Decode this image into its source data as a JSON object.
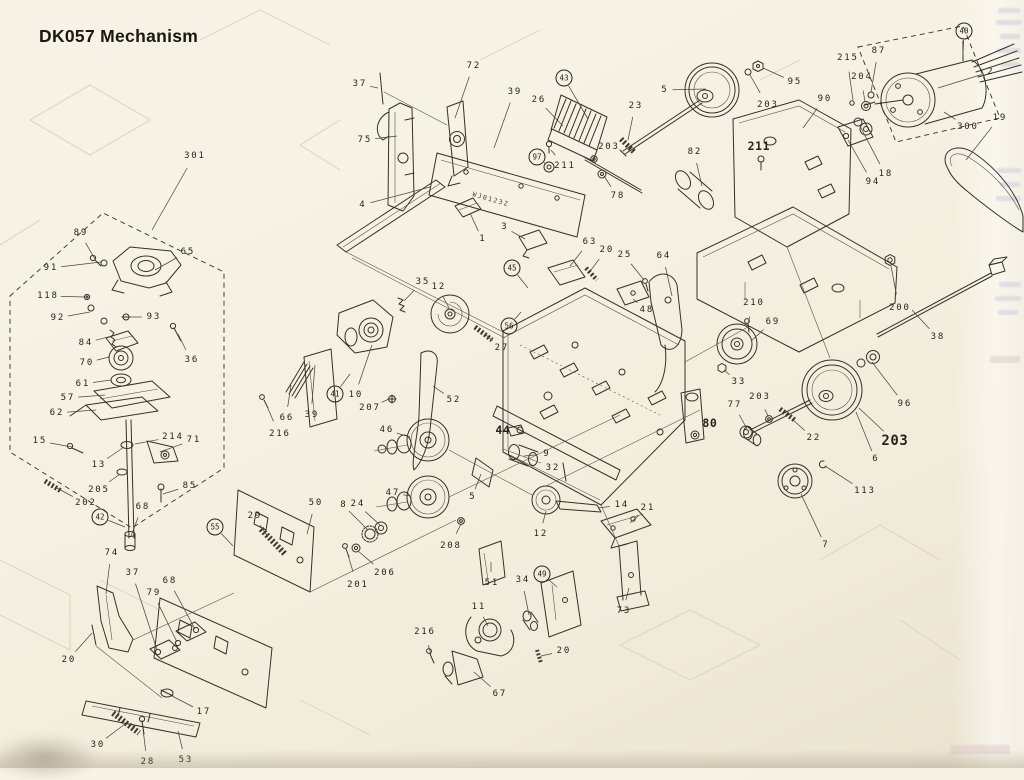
{
  "page": {
    "title": "DK057 Mechanism",
    "background": "#f5f0e2",
    "ink": "#2f2d28",
    "leader_color": "#4b4841"
  },
  "diagram": {
    "board_text": "WJ0123Z",
    "labels": [
      {
        "t": "301",
        "x": 194,
        "y": 156,
        "tx": 152,
        "ty": 230
      },
      {
        "t": "89",
        "x": 80,
        "y": 233,
        "tx": 96,
        "ty": 261
      },
      {
        "t": "65",
        "x": 187,
        "y": 252,
        "tx": 155,
        "ty": 270
      },
      {
        "t": "91",
        "x": 50,
        "y": 268,
        "tx": 101,
        "ty": 262
      },
      {
        "t": "118",
        "x": 47,
        "y": 296,
        "tx": 85,
        "ty": 297
      },
      {
        "t": "92",
        "x": 57,
        "y": 318,
        "tx": 90,
        "ty": 312
      },
      {
        "t": "93",
        "x": 153,
        "y": 317,
        "tx": 129,
        "ty": 317
      },
      {
        "t": "84",
        "x": 85,
        "y": 343,
        "tx": 112,
        "ty": 336
      },
      {
        "t": "36",
        "x": 191,
        "y": 360,
        "tx": 178,
        "ty": 334
      },
      {
        "t": "70",
        "x": 86,
        "y": 363,
        "tx": 109,
        "ty": 357
      },
      {
        "t": "61",
        "x": 82,
        "y": 384,
        "tx": 111,
        "ty": 380
      },
      {
        "t": "57",
        "x": 67,
        "y": 398,
        "tx": 105,
        "ty": 395
      },
      {
        "t": "62",
        "x": 56,
        "y": 413,
        "tx": 96,
        "ty": 410
      },
      {
        "t": "15",
        "x": 39,
        "y": 441,
        "tx": 72,
        "ty": 447
      },
      {
        "t": "214",
        "x": 172,
        "y": 437,
        "tx": 135,
        "ty": 444
      },
      {
        "t": "71",
        "x": 193,
        "y": 440,
        "tx": 160,
        "ty": 452
      },
      {
        "t": "13",
        "x": 98,
        "y": 465,
        "tx": 124,
        "ty": 447
      },
      {
        "t": "205",
        "x": 98,
        "y": 490,
        "tx": 120,
        "ty": 474
      },
      {
        "t": "85",
        "x": 189,
        "y": 486,
        "tx": 163,
        "ty": 494
      },
      {
        "t": "202",
        "x": 85,
        "y": 503,
        "tx": 55,
        "ty": 487
      },
      {
        "t": "42",
        "x": 100,
        "y": 517,
        "tx": 125,
        "ty": 527,
        "s": "circle"
      },
      {
        "t": "68",
        "x": 142,
        "y": 507,
        "tx": 131,
        "ty": 536
      },
      {
        "t": "74",
        "x": 111,
        "y": 553,
        "tx": 106,
        "ty": 594
      },
      {
        "t": "37",
        "x": 132,
        "y": 573,
        "tx": 157,
        "ty": 650
      },
      {
        "t": "79",
        "x": 153,
        "y": 593,
        "tx": 177,
        "ty": 642
      },
      {
        "t": "68",
        "x": 169,
        "y": 581,
        "tx": 195,
        "ty": 629
      },
      {
        "t": "20",
        "x": 68,
        "y": 660,
        "tx": 92,
        "ty": 633
      },
      {
        "t": "17",
        "x": 203,
        "y": 712,
        "tx": 172,
        "ty": 696
      },
      {
        "t": "30",
        "x": 97,
        "y": 745,
        "tx": 125,
        "ty": 724
      },
      {
        "t": "28",
        "x": 147,
        "y": 762,
        "tx": 143,
        "ty": 729
      },
      {
        "t": "53",
        "x": 185,
        "y": 760,
        "tx": 178,
        "ty": 731
      },
      {
        "t": "37",
        "x": 359,
        "y": 84,
        "tx": 378,
        "ty": 88
      },
      {
        "t": "72",
        "x": 473,
        "y": 66,
        "tx": 455,
        "ty": 118
      },
      {
        "t": "75",
        "x": 364,
        "y": 140,
        "tx": 397,
        "ty": 136
      },
      {
        "t": "4",
        "x": 362,
        "y": 205,
        "tx": 430,
        "ty": 187
      },
      {
        "t": "39",
        "x": 514,
        "y": 92,
        "tx": 494,
        "ty": 148
      },
      {
        "t": "26",
        "x": 538,
        "y": 100,
        "tx": 563,
        "ty": 126
      },
      {
        "t": "43",
        "x": 564,
        "y": 78,
        "tx": 588,
        "ty": 119,
        "s": "circle"
      },
      {
        "t": "97",
        "x": 537,
        "y": 157,
        "tx": 546,
        "ty": 164,
        "s": "circle"
      },
      {
        "t": "211",
        "x": 564,
        "y": 166,
        "tx": 551,
        "ty": 150
      },
      {
        "t": "203",
        "x": 608,
        "y": 147,
        "tx": 596,
        "ty": 157
      },
      {
        "t": "78",
        "x": 617,
        "y": 196,
        "tx": 604,
        "ty": 176
      },
      {
        "t": "1",
        "x": 482,
        "y": 239,
        "tx": 470,
        "ty": 213
      },
      {
        "t": "3",
        "x": 504,
        "y": 227,
        "tx": 525,
        "ty": 239
      },
      {
        "t": "63",
        "x": 589,
        "y": 242,
        "tx": 570,
        "ty": 266
      },
      {
        "t": "23",
        "x": 635,
        "y": 106,
        "tx": 628,
        "ty": 140
      },
      {
        "t": "5",
        "x": 664,
        "y": 90,
        "tx": 706,
        "ty": 89
      },
      {
        "t": "95",
        "x": 794,
        "y": 82,
        "tx": 763,
        "ty": 68
      },
      {
        "t": "203",
        "x": 767,
        "y": 105,
        "tx": 750,
        "ty": 75
      },
      {
        "t": "90",
        "x": 824,
        "y": 99,
        "tx": 803,
        "ty": 128
      },
      {
        "t": "82",
        "x": 694,
        "y": 152,
        "tx": 702,
        "ty": 186
      },
      {
        "t": "211",
        "x": 758,
        "y": 146,
        "tx": 761,
        "ty": 160,
        "s": "bold"
      },
      {
        "t": "215",
        "x": 847,
        "y": 58,
        "tx": 853,
        "ty": 100
      },
      {
        "t": "87",
        "x": 878,
        "y": 51,
        "tx": 871,
        "ty": 92
      },
      {
        "t": "204",
        "x": 861,
        "y": 77,
        "tx": 865,
        "ty": 102
      },
      {
        "t": "40",
        "x": 964,
        "y": 31,
        "tx": 963,
        "ty": 55,
        "s": "circle"
      },
      {
        "t": "2",
        "x": 990,
        "y": 72,
        "tx": 938,
        "ty": 88
      },
      {
        "t": "300",
        "x": 967,
        "y": 127,
        "tx": 944,
        "ty": 112
      },
      {
        "t": "19",
        "x": 999,
        "y": 118,
        "tx": 966,
        "ty": 160
      },
      {
        "t": "94",
        "x": 872,
        "y": 182,
        "tx": 848,
        "ty": 140
      },
      {
        "t": "18",
        "x": 885,
        "y": 174,
        "tx": 860,
        "ty": 126
      },
      {
        "t": "20",
        "x": 606,
        "y": 250,
        "tx": 591,
        "ty": 270
      },
      {
        "t": "25",
        "x": 624,
        "y": 255,
        "tx": 644,
        "ty": 280
      },
      {
        "t": "64",
        "x": 663,
        "y": 256,
        "tx": 672,
        "ty": 296
      },
      {
        "t": "48",
        "x": 646,
        "y": 310,
        "tx": 633,
        "ty": 299
      },
      {
        "t": "45",
        "x": 512,
        "y": 268,
        "tx": 528,
        "ty": 288,
        "s": "circle"
      },
      {
        "t": "56",
        "x": 509,
        "y": 326,
        "tx": 521,
        "ty": 312,
        "s": "circle"
      },
      {
        "t": "27",
        "x": 501,
        "y": 348,
        "tx": 486,
        "ty": 335
      },
      {
        "t": "210",
        "x": 753,
        "y": 303,
        "tx": 748,
        "ty": 324
      },
      {
        "t": "69",
        "x": 772,
        "y": 322,
        "tx": 751,
        "ty": 341
      },
      {
        "t": "200",
        "x": 899,
        "y": 308,
        "tx": 891,
        "ty": 266
      },
      {
        "t": "38",
        "x": 937,
        "y": 337,
        "tx": 912,
        "ty": 310
      },
      {
        "t": "33",
        "x": 738,
        "y": 382,
        "tx": 724,
        "ty": 370
      },
      {
        "t": "203",
        "x": 759,
        "y": 397,
        "tx": 768,
        "ty": 416
      },
      {
        "t": "77",
        "x": 734,
        "y": 405,
        "tx": 747,
        "ty": 429
      },
      {
        "t": "22",
        "x": 813,
        "y": 438,
        "tx": 792,
        "ty": 419
      },
      {
        "t": "96",
        "x": 904,
        "y": 404,
        "tx": 872,
        "ty": 362
      },
      {
        "t": "203",
        "x": 894,
        "y": 441,
        "tx": 859,
        "ty": 408,
        "s": "big"
      },
      {
        "t": "6",
        "x": 875,
        "y": 459,
        "tx": 856,
        "ty": 412
      },
      {
        "t": "113",
        "x": 864,
        "y": 491,
        "tx": 825,
        "ty": 466
      },
      {
        "t": "7",
        "x": 825,
        "y": 545,
        "tx": 801,
        "ty": 494
      },
      {
        "t": "80",
        "x": 709,
        "y": 423,
        "tx": 698,
        "ty": 419,
        "s": "bold"
      },
      {
        "t": "35",
        "x": 422,
        "y": 282,
        "tx": 404,
        "ty": 301
      },
      {
        "t": "12",
        "x": 438,
        "y": 287,
        "tx": 449,
        "ty": 308
      },
      {
        "t": "41",
        "x": 335,
        "y": 394,
        "tx": 350,
        "ty": 374,
        "s": "circle"
      },
      {
        "t": "10",
        "x": 355,
        "y": 395,
        "tx": 372,
        "ty": 345
      },
      {
        "t": "207",
        "x": 369,
        "y": 408,
        "tx": 389,
        "ty": 399
      },
      {
        "t": "39",
        "x": 311,
        "y": 415,
        "tx": 315,
        "ty": 365
      },
      {
        "t": "66",
        "x": 286,
        "y": 418,
        "tx": 291,
        "ty": 385
      },
      {
        "t": "216",
        "x": 279,
        "y": 434,
        "tx": 266,
        "ty": 404
      },
      {
        "t": "52",
        "x": 453,
        "y": 400,
        "tx": 433,
        "ty": 386
      },
      {
        "t": "46",
        "x": 386,
        "y": 430,
        "tx": 410,
        "ty": 437
      },
      {
        "t": "44",
        "x": 502,
        "y": 430,
        "tx": 511,
        "ty": 432,
        "s": "bold"
      },
      {
        "t": "9",
        "x": 546,
        "y": 454,
        "tx": 524,
        "ty": 456
      },
      {
        "t": "32",
        "x": 552,
        "y": 468,
        "tx": 562,
        "ty": 472
      },
      {
        "t": "5",
        "x": 472,
        "y": 497,
        "tx": 481,
        "ty": 474
      },
      {
        "t": "47",
        "x": 392,
        "y": 493,
        "tx": 411,
        "ty": 496
      },
      {
        "t": "50",
        "x": 315,
        "y": 503,
        "tx": 307,
        "ty": 534
      },
      {
        "t": "8",
        "x": 343,
        "y": 505,
        "tx": 368,
        "ty": 530
      },
      {
        "t": "24",
        "x": 357,
        "y": 504,
        "tx": 380,
        "ty": 525
      },
      {
        "t": "29",
        "x": 254,
        "y": 516,
        "tx": 268,
        "ty": 537
      },
      {
        "t": "55",
        "x": 215,
        "y": 527,
        "tx": 233,
        "ty": 546,
        "s": "circle"
      },
      {
        "t": "206",
        "x": 384,
        "y": 573,
        "tx": 358,
        "ty": 551
      },
      {
        "t": "201",
        "x": 357,
        "y": 585,
        "tx": 348,
        "ty": 555
      },
      {
        "t": "208",
        "x": 450,
        "y": 546,
        "tx": 461,
        "ty": 524
      },
      {
        "t": "12",
        "x": 540,
        "y": 534,
        "tx": 546,
        "ty": 511
      },
      {
        "t": "14",
        "x": 621,
        "y": 505,
        "tx": 598,
        "ty": 508
      },
      {
        "t": "21",
        "x": 647,
        "y": 508,
        "tx": 630,
        "ty": 523
      },
      {
        "t": "49",
        "x": 542,
        "y": 574,
        "tx": 557,
        "ty": 587,
        "s": "circle"
      },
      {
        "t": "51",
        "x": 491,
        "y": 583,
        "tx": 491,
        "ty": 562
      },
      {
        "t": "34",
        "x": 522,
        "y": 580,
        "tx": 529,
        "ty": 615
      },
      {
        "t": "11",
        "x": 478,
        "y": 607,
        "tx": 488,
        "ty": 626
      },
      {
        "t": "216",
        "x": 424,
        "y": 632,
        "tx": 431,
        "ty": 654
      },
      {
        "t": "20",
        "x": 563,
        "y": 651,
        "tx": 541,
        "ty": 656
      },
      {
        "t": "67",
        "x": 499,
        "y": 694,
        "tx": 474,
        "ty": 672
      },
      {
        "t": "73",
        "x": 623,
        "y": 611,
        "tx": 629,
        "ty": 588
      }
    ]
  }
}
